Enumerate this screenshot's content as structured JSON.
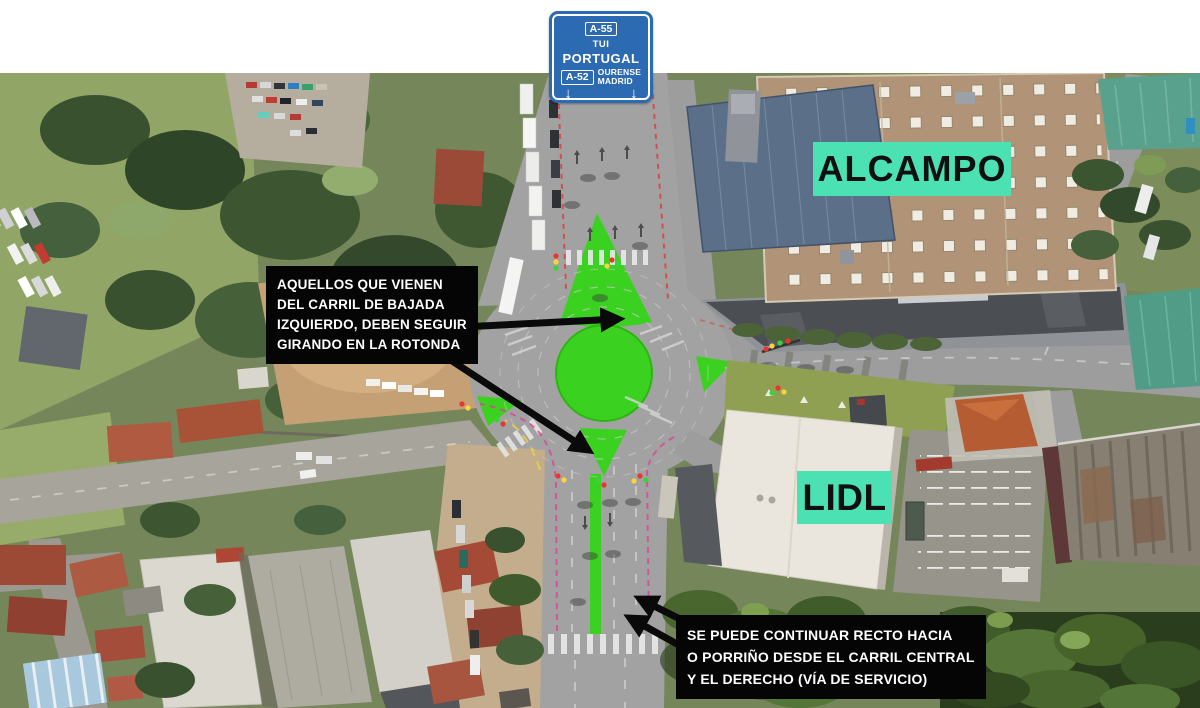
{
  "sign": {
    "badge_top": "A-55",
    "dest_top_1": "TUI",
    "dest_top_2": "PORTUGAL",
    "badge_bottom": "A-52",
    "dest_bottom_1": "OURENSE",
    "dest_bottom_2": "MADRID",
    "arrow_down_glyph": "↓",
    "colors": {
      "background": "#2C6AB2",
      "text": "#FFFFFF"
    }
  },
  "labels": {
    "alcampo": "ALCAMPO",
    "lidl": "LIDL",
    "colors": {
      "background": "#4CE1B2",
      "text": "#101010"
    }
  },
  "notes": {
    "note1": {
      "lines": [
        "AQUELLOS QUE VIENEN",
        "DEL CARRIL DE BAJADA",
        "IZQUIERDO, DEBEN SEGUIR",
        "GIRANDO EN LA ROTONDA"
      ]
    },
    "note2": {
      "lines": [
        "SE PUEDE CONTINUAR RECTO HACIA",
        "O PORRIÑO DESDE EL CARRIL CENTRAL",
        "Y EL DERECHO (VÍA DE SERVICIO)"
      ]
    },
    "colors": {
      "background": "#050505",
      "text": "#FFFFFF",
      "arrow": "#0A0A0A"
    }
  },
  "map_colors": {
    "roundabout_paint_green": "#3BD120",
    "road_grey": "#A2A2A2",
    "route_line_magenta": "#E23B97",
    "route_line_red": "#E03333",
    "route_line_yellow": "#ECD53D"
  }
}
